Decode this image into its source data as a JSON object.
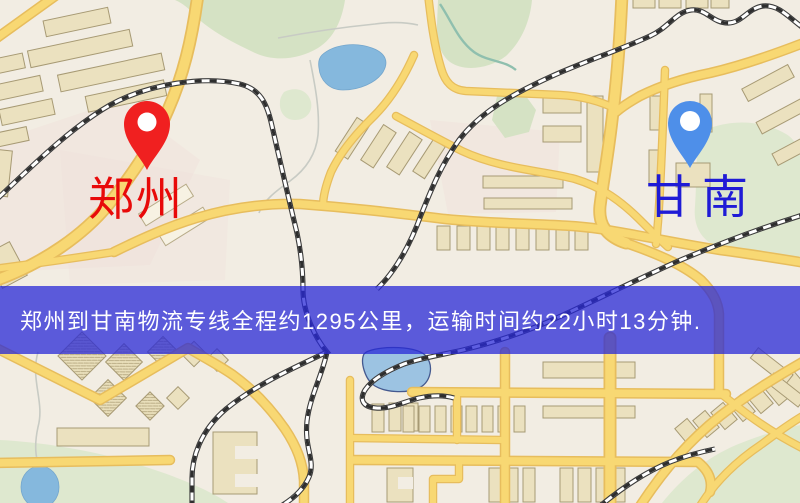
{
  "banner": {
    "text": "郑州到甘南物流专线全程约1295公里，运输时间约22小时13分钟.",
    "bg_color": "rgba(40,40,215,0.75)",
    "text_color": "#ffffff",
    "distance_km": "1295",
    "duration": "22小时13分钟"
  },
  "markers": {
    "origin": {
      "label": "郑州",
      "pin_color": "#f02020",
      "label_color": "#e80a0a"
    },
    "destination": {
      "label": "甘南",
      "pin_color": "#4e8fe9",
      "label_color": "#1f1bd6"
    }
  },
  "map": {
    "colors": {
      "background": "#f2ede3",
      "road_fill": "#f8d873",
      "road_casing": "#e7bd5d",
      "park": "#d5e2c4",
      "water": "#85b8dd",
      "building_fill": "#ebe1bf",
      "building_outline": "#a79a74",
      "railway": "#3c3c3c"
    }
  }
}
